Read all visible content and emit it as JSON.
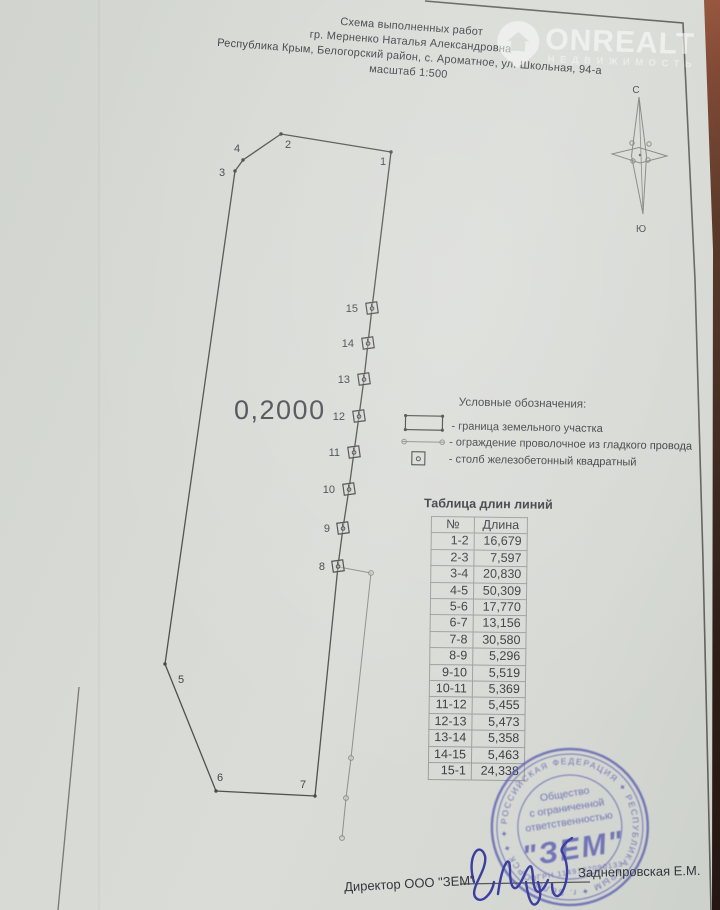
{
  "header": {
    "lines": [
      "Схема выполненных работ",
      "гр. Мерненко Наталья Александровна",
      "Республика Крым, Белогорский район, с. Ароматное, ул. Школьная, 94-а",
      "масштаб 1:500"
    ]
  },
  "watermark": {
    "brand": "ONREALT",
    "subtitle": "НЕДВИЖИМОСТЬ"
  },
  "compass": {
    "north": "С",
    "south": "Ю"
  },
  "plot": {
    "area_label": "0,2000",
    "outline": [
      {
        "label": "1",
        "x": 391,
        "y": 152,
        "type": "corner",
        "lx": 383,
        "ly": 165
      },
      {
        "label": "2",
        "x": 281,
        "y": 134,
        "type": "corner",
        "lx": 288,
        "ly": 148
      },
      {
        "label": "4",
        "x": 243,
        "y": 160,
        "type": "corner",
        "lx": 237,
        "ly": 152
      },
      {
        "label": "3",
        "x": 235,
        "y": 171,
        "type": "corner",
        "lx": 222,
        "ly": 176
      },
      {
        "label": "5",
        "x": 165,
        "y": 664,
        "type": "corner",
        "lx": 181,
        "ly": 683
      },
      {
        "label": "6",
        "x": 216,
        "y": 791,
        "type": "corner",
        "lx": 220,
        "ly": 781
      },
      {
        "label": "7",
        "x": 315,
        "y": 796,
        "type": "corner",
        "lx": 303,
        "ly": 788
      },
      {
        "label": "8",
        "x": 338,
        "y": 566,
        "type": "post",
        "lx": 325,
        "ly": 570
      },
      {
        "label": "9",
        "x": 343,
        "y": 528,
        "type": "post",
        "lx": 330,
        "ly": 532
      },
      {
        "label": "10",
        "x": 349,
        "y": 489,
        "type": "post",
        "lx": 335,
        "ly": 493
      },
      {
        "label": "11",
        "x": 354,
        "y": 452,
        "type": "post",
        "lx": 340,
        "ly": 456
      },
      {
        "label": "12",
        "x": 359,
        "y": 416,
        "type": "post",
        "lx": 345,
        "ly": 420
      },
      {
        "label": "13",
        "x": 364,
        "y": 379,
        "type": "post",
        "lx": 350,
        "ly": 383
      },
      {
        "label": "14",
        "x": 368,
        "y": 343,
        "type": "post",
        "lx": 354,
        "ly": 347
      },
      {
        "label": "15",
        "x": 372,
        "y": 308,
        "type": "post",
        "lx": 358,
        "ly": 312
      }
    ],
    "fence": [
      [
        339,
        567
      ],
      [
        371,
        573
      ],
      [
        351,
        758
      ],
      [
        346,
        798
      ],
      [
        342,
        838
      ]
    ]
  },
  "legend": {
    "title": "Условные обозначения:",
    "items": [
      {
        "label": "- граница земельного участка"
      },
      {
        "label": "- ограждение проволочное из гладкого провода"
      },
      {
        "label": "- столб железобетонный квадратный"
      }
    ]
  },
  "table": {
    "title": "Таблица длин линий",
    "columns": [
      "№",
      "Длина"
    ],
    "rows": [
      [
        "1-2",
        "16,679"
      ],
      [
        "2-3",
        "7,597"
      ],
      [
        "3-4",
        "20,830"
      ],
      [
        "4-5",
        "50,309"
      ],
      [
        "5-6",
        "17,770"
      ],
      [
        "6-7",
        "13,156"
      ],
      [
        "7-8",
        "30,580"
      ],
      [
        "8-9",
        "5,296"
      ],
      [
        "9-10",
        "5,519"
      ],
      [
        "10-11",
        "5,369"
      ],
      [
        "11-12",
        "5,455"
      ],
      [
        "12-13",
        "5,473"
      ],
      [
        "13-14",
        "5,358"
      ],
      [
        "14-15",
        "5,463"
      ],
      [
        "15-1",
        "24,338"
      ]
    ]
  },
  "stamp": {
    "ring_text": "✦ РОССИЙСКАЯ ФЕДЕРАЦИЯ ✦ РЕСПУБЛИКА КРЫМ ✦ г. БЕЛОГОРСК ✦",
    "line1": "Общество",
    "line2": "с ограниченной",
    "line3": "ответственностью",
    "name": "\"ЗЕМ\"",
    "ogrn": "ОГРН 1149102090133"
  },
  "footer": {
    "director_label": "Директор  ООО \"ЗЕМ\"",
    "signer_name": "Заднепровская Е.М."
  },
  "colors": {
    "paper": "#d6d8d4",
    "ink": "#3f4347",
    "drawing_line": "#50504e",
    "fence_line": "#8e8e8a",
    "stamp_blue": "#5d60b0",
    "signature_blue": "#3c3ea0",
    "photo_edge": "#8d4c36"
  }
}
